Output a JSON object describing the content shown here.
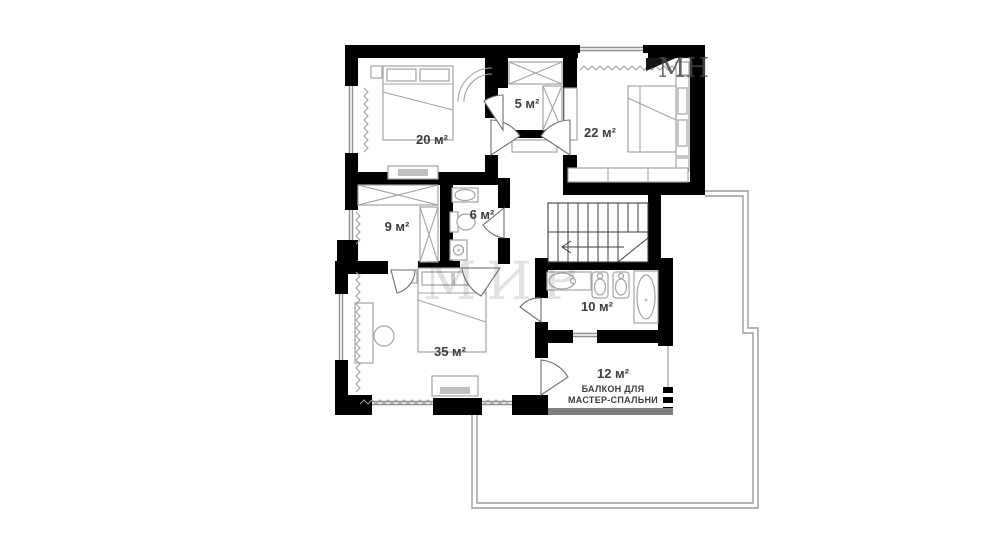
{
  "plan": {
    "rooms": [
      {
        "id": "bedroom-20",
        "label": "20 м²"
      },
      {
        "id": "closet-5",
        "label": "5 м²"
      },
      {
        "id": "bedroom-22",
        "label": "22 м²"
      },
      {
        "id": "wardrobe-9",
        "label": "9 м²"
      },
      {
        "id": "bathroom-6",
        "label": "6 м²"
      },
      {
        "id": "bathroom-10",
        "label": "10 м²"
      },
      {
        "id": "master-bedroom-35",
        "label": "35 м²"
      },
      {
        "id": "balcony-12",
        "label": "12 м²",
        "caption_line1": "БАЛКОН ДЛЯ",
        "caption_line2": "МАСТЕР-СПАЛЬНИ"
      }
    ],
    "watermarks": {
      "top_right": "МН",
      "center": "МИР"
    },
    "colors": {
      "wall": "#000000",
      "furniture_line": "#a3a3a3",
      "label_text": "#3d3d3d",
      "roof_outline": "#9b9b9b",
      "balcony_wall": "#7e7e7e"
    }
  }
}
